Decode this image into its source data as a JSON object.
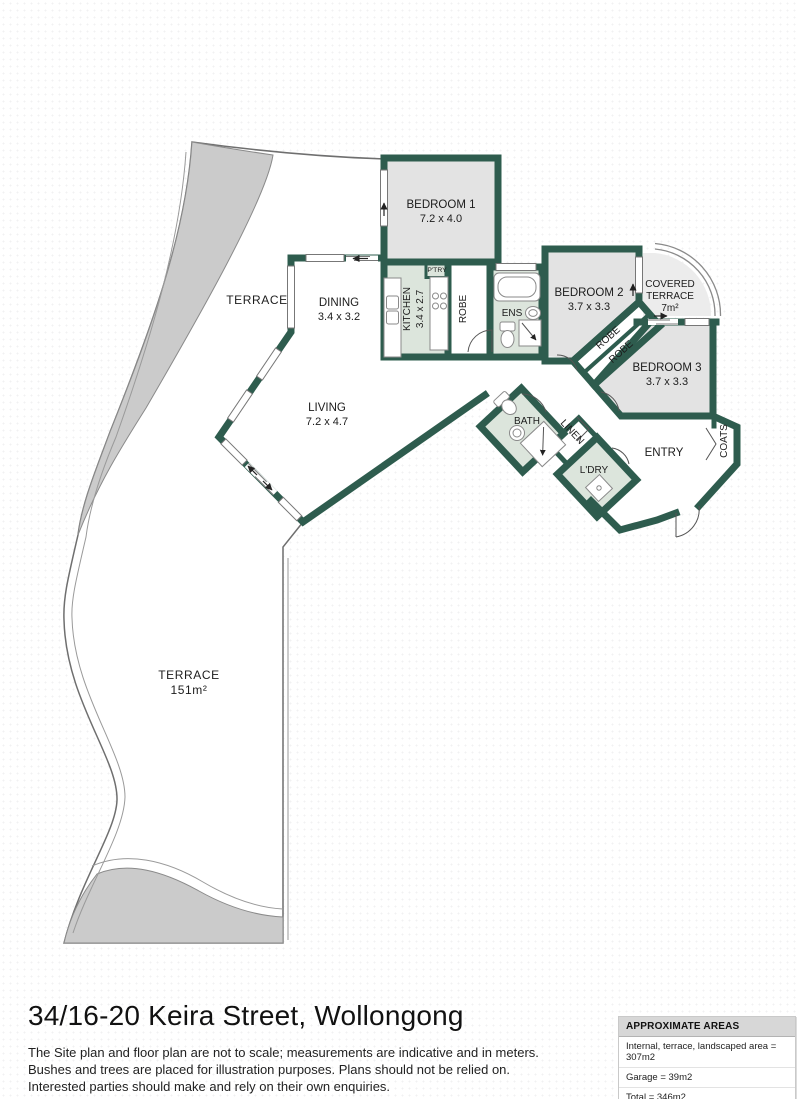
{
  "page": {
    "title": "34/16-20 Keira Street, Wollongong",
    "disclaimer": [
      "The Site plan and floor plan are not to scale; measurements are indicative and in meters.",
      "Bushes and trees are placed for illustration purposes. Plans should not be relied on.",
      "Interested parties should make and rely on their own enquiries."
    ]
  },
  "areas_box": {
    "header": "APPROXIMATE AREAS",
    "rows": [
      "Internal, terrace, landscaped area = 307m2",
      "Garage = 39m2",
      "Total = 346m2"
    ]
  },
  "floorplan": {
    "rooms": {
      "bedroom1": {
        "name": "BEDROOM 1",
        "dims": "7.2 x 4.0"
      },
      "bedroom2": {
        "name": "BEDROOM 2",
        "dims": "3.7 x 3.3"
      },
      "bedroom3": {
        "name": "BEDROOM 3",
        "dims": "3.7 x 3.3"
      },
      "covered_terrace": {
        "line1": "COVERED",
        "line2": "TERRACE",
        "area": "7m²"
      },
      "dining": {
        "name": "DINING",
        "dims": "3.4 x 3.2"
      },
      "living": {
        "name": "LIVING",
        "dims": "7.2 x 4.7"
      },
      "kitchen": {
        "name": "KITCHEN",
        "dims": "3.4 x 2.7"
      },
      "pantry": {
        "name": "P'TRY"
      },
      "robe_bed1": {
        "name": "ROBE"
      },
      "robe_hall_1": {
        "name": "ROBE"
      },
      "robe_hall_2": {
        "name": "ROBE"
      },
      "ens": {
        "name": "ENS"
      },
      "bath": {
        "name": "BATH"
      },
      "linen": {
        "name": "LINEN"
      },
      "laundry": {
        "name": "L'DRY"
      },
      "entry": {
        "name": "ENTRY"
      },
      "coats": {
        "name": "COATS"
      },
      "terrace_upper": {
        "name": "TERRACE"
      },
      "terrace_lower": {
        "name": "TERRACE",
        "area": "151m²"
      }
    },
    "colors": {
      "wall": "#2e5c4e",
      "room_fill": "#e3e3e3",
      "wet_area_fill": "#dce5dc",
      "covered_terrace_fill": "#ececec",
      "landscape_fill": "#cbcbcb",
      "outline": "#8a8a8a"
    }
  }
}
